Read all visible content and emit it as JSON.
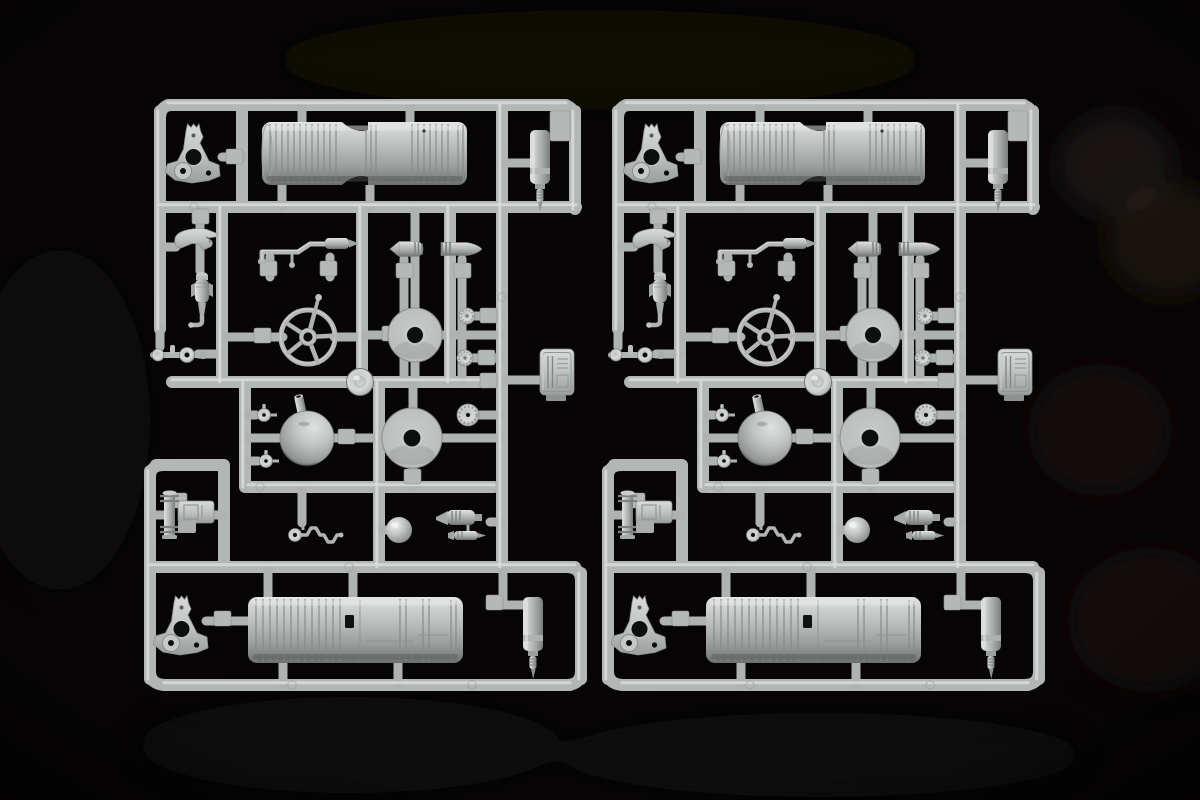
{
  "image": {
    "kind": "photograph",
    "width": 1200,
    "height": 800,
    "description": "Two identical light-gray injection-molded plastic model kit sprues (parts runners) lying side by side on a black felt background, photographed from above with soft studio lighting and dark circular smudges visible in the felt on the right side."
  },
  "sprues": [
    {
      "label": "left sprue",
      "x": 142,
      "y": 97,
      "width": 450,
      "height": 600
    },
    {
      "label": "right sprue",
      "x": 600,
      "y": 97,
      "width": 450,
      "height": 600
    }
  ],
  "parts_per_sprue": [
    "large ribbed engine cylinder (top row)",
    "large ribbed engine cylinder with hatch slot (bottom row)",
    "Y-shaped mounting bracket with holes (top left)",
    "Y-shaped mounting bracket with holes (bottom left)",
    "small ribbed canister with threaded tip (top right)",
    "small ribbed canister with threaded tip (bottom right)",
    "curved claw hook",
    "finned bomb-shaped fitting with elbow pipe",
    "stepped control rod with spindle end",
    "torpedo-shaped fitting pointing left",
    "torpedo-shaped fitting pointing right",
    "five-spoke handwheel with grip handle",
    "flat disc with center hole (middle row)",
    "flat disc with center hole (funnel row)",
    "bell-shaped funnel dome with spout",
    "glossy domed cap on lower rail",
    "two small knurled knobs on right spine",
    "large knurled knob on right spine",
    "two miniature valve hand-knobs",
    "small polished sphere",
    "crank linkage with pulley wheel",
    "flanged valve pin with block body",
    "ribbed valve cylinder pair",
    "rectangular louvered hatch panel (right edge)",
    "double-knob linkage bar",
    "square attachment tabs",
    "ejector-pin marks on runners"
  ],
  "colors": {
    "background": "#070505",
    "smudge": "#261e19",
    "rail": "#b2b6b4",
    "rail_highlight": "#dcdfdd",
    "stub": "#aeb2b0",
    "tab": "#b4b8b6",
    "plastic_light": "#e4e6e5",
    "plastic_mid": "#b5b9b7",
    "plastic_dark": "#6a6e6d",
    "hole": "#0d0e0e"
  }
}
